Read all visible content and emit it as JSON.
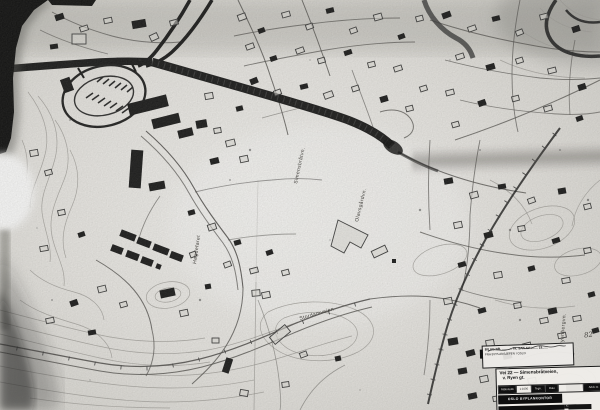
{
  "colors": {
    "paper": "#e8e6e2",
    "paper_bright": "#f7f6f3",
    "paper_shadow": "#b6b4b0",
    "ink": "#141414",
    "ink_light": "#4f4d4a",
    "contour": "#a09e99"
  },
  "street_labels": [
    {
      "text": "Simensbråtvn."
    },
    {
      "text": "Olavsgårdvn."
    },
    {
      "text": "Høgdefaret"
    },
    {
      "text": "Stordamveien"
    },
    {
      "text": "Ryenbergvn."
    }
  ],
  "annotations": {
    "sheet_note": "82"
  },
  "stamp": {
    "line1": "BILAG NR. ........... TIL SAK AV ........ 19......",
    "line2": "FRA BYPLANSJEFEN I OSLO"
  },
  "title_block": {
    "line1": "Vei 22 — Simensbråtveien,",
    "line2": "v. Ryen gt.",
    "cells": [
      {
        "label": "Målestokk"
      },
      {
        "label": "1:1000"
      },
      {
        "label": "Tegn."
      },
      {
        "label": "Dato"
      },
      {
        "label": ""
      },
      {
        "label": "Arkiv nr."
      }
    ],
    "footer_left": "OSLO BYPLANKONTOR",
    "footer_right": "Kontroll"
  }
}
